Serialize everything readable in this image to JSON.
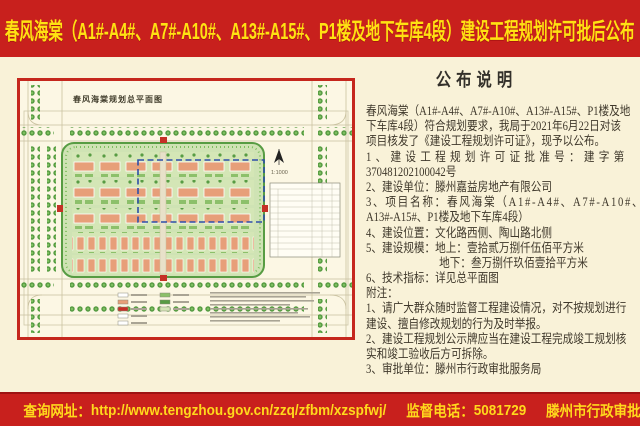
{
  "page": {
    "title": "春风海棠（A1#-A4#、A7#-A10#、A13#-A15#、P1楼及地下车库4段）建设工程规划许可批后公布"
  },
  "map": {
    "title": "春风海棠规划总平面图",
    "scale": "1:1000"
  },
  "notice": {
    "heading": "公布说明",
    "lines": [
      "春风海棠（A1#-A4#、A7#-A10#、A13#-A15#、P1楼及地",
      "下车库4段）符合规划要求，我局于2021年6月22日对该",
      "项目核发了《建设工程规划许可证》，现予以公布。",
      "1、建设工程规划许可证批准号：建字第",
      "370481202100042号",
      "2、建设单位：滕州嘉益房地产有限公司",
      "3、项目名称：春风海棠（A1#-A4#、A7#-A10#、",
      "A13#-A15#、P1楼及地下车库4段）",
      "4、建设位置：文化路西侧、陶山路北侧",
      "5、建设规模：地上：壹拾贰万捌仟伍佰平方米",
      "地下：叁万捌仟玖佰壹拾平方米",
      "6、技术指标：详见总平面图",
      "附注：",
      "1、请广大群众随时监督工程建设情况，对不按规划进行",
      "建设、擅自修改规划的行为及时举报。",
      "2、建设工程规划公示牌应当在建设工程完成竣工规划核",
      "实和竣工验收后方可拆除。",
      "3、审批单位：滕州市行政审批服务局"
    ]
  },
  "footer": {
    "query_label": "查询网址：",
    "query_url": "http://www.tengzhou.gov.cn/zzq/zfbm/xzspfwj/",
    "phone_label": "监督电话：",
    "phone": "5081729",
    "issuer": "滕州市行政审批服务局监制"
  },
  "colors": {
    "banner_red": "#c8201d",
    "banner_yellow": "#ffe212",
    "page_cream": "#f9f2d8",
    "map_border_red": "#c5271d",
    "site_green": "#cfe3b4",
    "boundary_blue": "#2e4ea8"
  }
}
